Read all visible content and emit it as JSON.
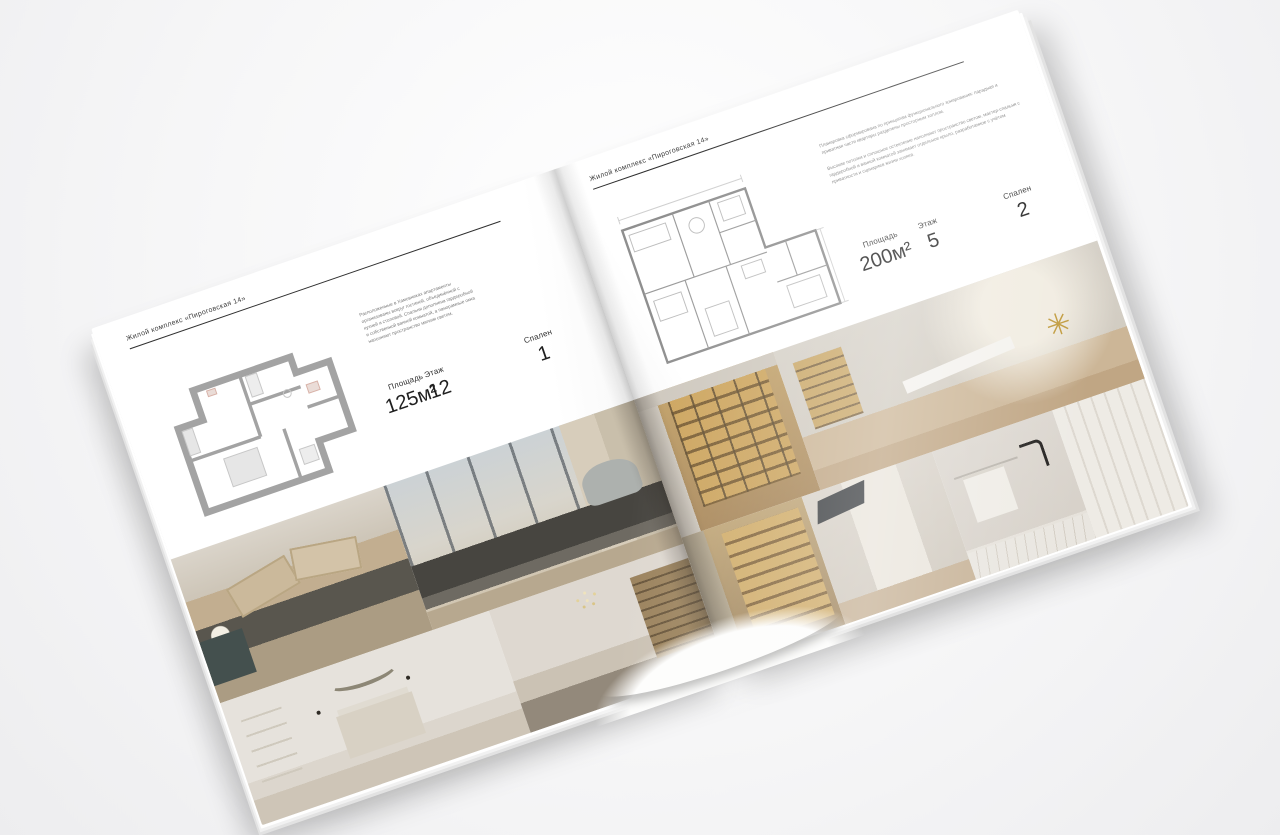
{
  "palette": {
    "background": "#f6f6f7",
    "paper": "#ffffff",
    "ink": "#3b3b3b",
    "rule": "#2f2f2f",
    "plan_wall": "#a3a3a3",
    "photo_beige": "#cbb9a2",
    "photo_dark_bed": "#59564e",
    "shelf_amber": "#c9a45f"
  },
  "icons": {
    "sputnik_lamp": "✳"
  },
  "left_page": {
    "header": "Жилой комплекс «Пироговская 14»",
    "description": "Расположенные в Хамовниках апартаменты организованы вокруг гостиной, объединённой с кухней и столовой. Спальня дополнена гардеробной и собственной ванной комнатой, а панорамные окна наполняют пространство мягким светом.",
    "stats": {
      "area_label": "Площадь",
      "area_value": "125м²",
      "floor_label": "Этаж",
      "floor_value": "12",
      "bedrooms_label": "Спален",
      "bedrooms_value": "1"
    },
    "floor_plan": "one-bedroom-apartment-plan",
    "photos": [
      "bedroom-with-beige-pillows",
      "bedroom-with-panoramic-window",
      "white-bedroom-with-arc-decor",
      "hallway-with-chandelier-and-bookcase"
    ]
  },
  "right_page": {
    "header": "Жилой комплекс «Пироговская 14»",
    "description_1": "Планировка сформирована по принципам функционального зонирования: парадная и приватная части квартиры разделены просторным холлом.",
    "description_2": "Высокие потолки и сплошное остекление наполняют пространство светом, мастер-спальня с гардеробной и ванной комнатой занимает отдельное крыло, разработанное с учётом приватности и сценариев жизни хозяев.",
    "stats": {
      "area_label": "Площадь",
      "area_value": "200м²",
      "floor_label": "Этаж",
      "floor_value": "5",
      "bedrooms_label": "Спален",
      "bedrooms_value": "2"
    },
    "floor_plan": "two-bedroom-apartment-plan",
    "photos": [
      "dressing-room-lit-wardrobe",
      "study-with-desk-and-gold-lamp",
      "closet-with-lit-shelves",
      "hallway-with-laptop",
      "bathroom-with-towel-and-black-faucet",
      "white-wardrobe-panels"
    ]
  }
}
